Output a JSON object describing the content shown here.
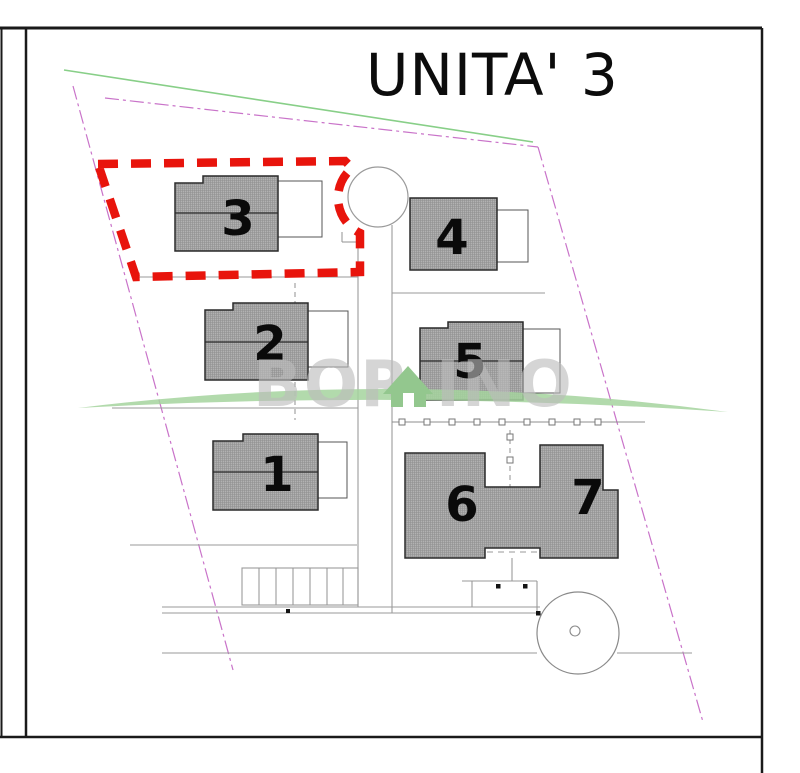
{
  "title": "UNITA' 3",
  "highlighted_unit": "3",
  "units": [
    {
      "label": "1"
    },
    {
      "label": "2"
    },
    {
      "label": "3"
    },
    {
      "label": "4"
    },
    {
      "label": "5"
    },
    {
      "label": "6"
    },
    {
      "label": "7"
    }
  ],
  "watermark": {
    "text_left": "BOR",
    "text_right": "INO",
    "icon": "house-icon"
  },
  "colors": {
    "highlight_red": "#e8140c",
    "parcel_boundary_magenta": "#c973c9",
    "survey_line_green": "#88cf88",
    "building_hatch_gray": "#b3b3b3",
    "watermark_green": "#9ccb95",
    "watermark_gray": "#bcbcbc",
    "frame_black": "#1a1a1a"
  }
}
